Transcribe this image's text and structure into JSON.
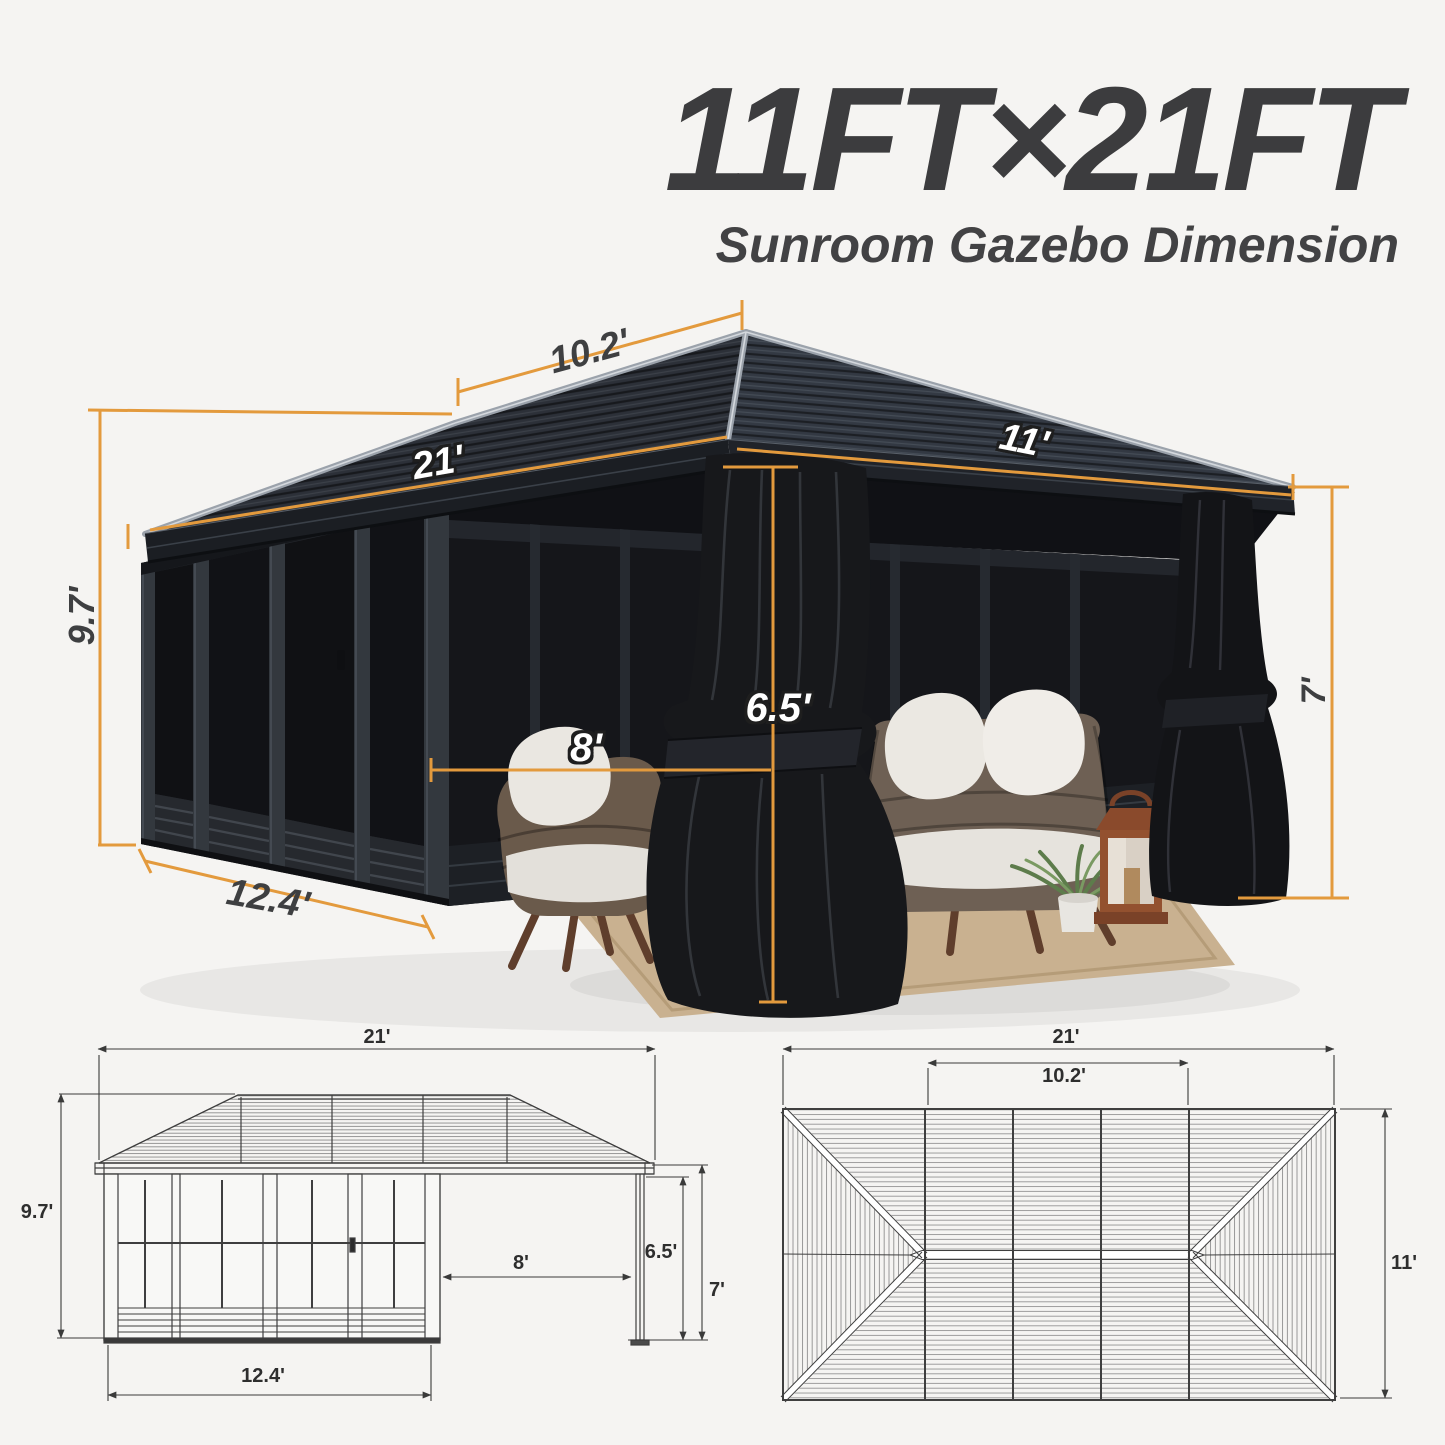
{
  "header": {
    "title": "11FT×21FT",
    "subtitle": "Sunroom Gazebo Dimension"
  },
  "photo": {
    "dims": {
      "ridge": "10.2'",
      "length": "21'",
      "width": "11'",
      "height": "9.7'",
      "sunroom_width": "12.4'",
      "opening_width": "8'",
      "opening_height": "6.5'",
      "post_height": "7'"
    }
  },
  "elevation": {
    "dims": {
      "length": "21'",
      "height": "9.7'",
      "sunroom_width": "12.4'",
      "opening_width": "8'",
      "opening_height": "6.5'",
      "post_height": "7'"
    }
  },
  "plan": {
    "dims": {
      "length": "21'",
      "ridge": "10.2'",
      "width": "11'"
    }
  },
  "colors": {
    "background": "#f5f4f2",
    "dimension_accent": "#e39a3d",
    "drawing_line": "#3f3f3f",
    "title_text": "#3c3c3e",
    "roof_dark": "#2c3038"
  }
}
